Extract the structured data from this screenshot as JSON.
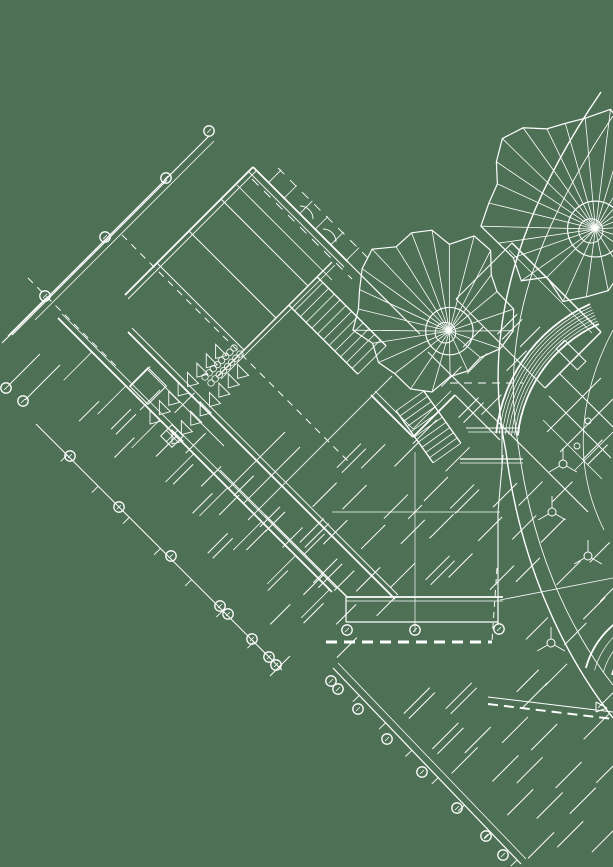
{
  "canvas": {
    "width": 613,
    "height": 867
  },
  "colors": {
    "background": "#4e7055",
    "ink": "#ffffff"
  },
  "drawing": {
    "lines": [
      {
        "x1": 209,
        "y1": 136,
        "x2": 30,
        "y2": 315,
        "w": 1.2
      },
      {
        "x1": 214,
        "y1": 141,
        "x2": 35,
        "y2": 320,
        "w": 0.8
      },
      {
        "x1": 167,
        "y1": 180,
        "x2": 12,
        "y2": 335,
        "w": 1.2
      },
      {
        "x1": 106,
        "y1": 239,
        "x2": 2,
        "y2": 343,
        "w": 1.2
      },
      {
        "x1": 46,
        "y1": 298,
        "x2": 8,
        "y2": 336,
        "w": 1.2
      },
      {
        "x1": 8,
        "y1": 386,
        "x2": 40,
        "y2": 354,
        "w": 1
      },
      {
        "x1": 25,
        "y1": 400,
        "x2": 60,
        "y2": 365,
        "w": 1
      },
      {
        "x1": 122,
        "y1": 235,
        "x2": 348,
        "y2": 461,
        "w": 1,
        "dash": [
          7,
          6
        ]
      },
      {
        "x1": 28,
        "y1": 278,
        "x2": 118,
        "y2": 368,
        "w": 1,
        "dash": [
          7,
          6
        ]
      },
      {
        "x1": 252,
        "y1": 179,
        "x2": 352,
        "y2": 279,
        "w": 1,
        "dash": [
          9,
          8
        ]
      },
      {
        "x1": 278,
        "y1": 168,
        "x2": 368,
        "y2": 258,
        "w": 0.9,
        "dash": [
          9,
          8
        ]
      },
      {
        "x1": 58,
        "y1": 318,
        "x2": 332,
        "y2": 592,
        "w": 1.8
      },
      {
        "x1": 62,
        "y1": 314,
        "x2": 336,
        "y2": 588,
        "w": 0.8
      },
      {
        "x1": 36,
        "y1": 424,
        "x2": 282,
        "y2": 670,
        "w": 1
      },
      {
        "x1": 128,
        "y1": 332,
        "x2": 395,
        "y2": 599,
        "w": 1.8
      },
      {
        "x1": 132,
        "y1": 328,
        "x2": 398,
        "y2": 595,
        "w": 0.9
      },
      {
        "x1": 253,
        "y1": 167,
        "x2": 125,
        "y2": 295,
        "w": 1.8
      },
      {
        "x1": 256,
        "y1": 171,
        "x2": 128,
        "y2": 299,
        "w": 0.9
      },
      {
        "x1": 253,
        "y1": 167,
        "x2": 348,
        "y2": 262,
        "w": 1.8
      },
      {
        "x1": 249,
        "y1": 172,
        "x2": 344,
        "y2": 267,
        "w": 0.9
      },
      {
        "x1": 237,
        "y1": 185,
        "x2": 332,
        "y2": 280,
        "w": 0.8
      },
      {
        "x1": 348,
        "y1": 262,
        "x2": 420,
        "y2": 334,
        "w": 1.2
      },
      {
        "x1": 218,
        "y1": 376,
        "x2": 332,
        "y2": 262,
        "w": 1.5
      },
      {
        "x1": 221,
        "y1": 379,
        "x2": 335,
        "y2": 265,
        "w": 0.8
      },
      {
        "x1": 157,
        "y1": 263,
        "x2": 244,
        "y2": 350,
        "w": 1
      },
      {
        "x1": 189,
        "y1": 231,
        "x2": 276,
        "y2": 318,
        "w": 1
      },
      {
        "x1": 221,
        "y1": 199,
        "x2": 308,
        "y2": 286,
        "w": 1
      },
      {
        "x1": 148,
        "y1": 370,
        "x2": 224,
        "y2": 446,
        "w": 0.9
      },
      {
        "x1": 166,
        "y1": 430,
        "x2": 178,
        "y2": 442,
        "w": 0.8
      },
      {
        "x1": 166,
        "y1": 442,
        "x2": 178,
        "y2": 430,
        "w": 0.8
      },
      {
        "x1": 371,
        "y1": 395,
        "x2": 413,
        "y2": 437,
        "w": 1.8
      },
      {
        "x1": 413,
        "y1": 437,
        "x2": 455,
        "y2": 395,
        "w": 1.8
      },
      {
        "x1": 375,
        "y1": 391,
        "x2": 413,
        "y2": 429,
        "w": 0.8
      },
      {
        "x1": 413,
        "y1": 429,
        "x2": 451,
        "y2": 391,
        "w": 0.8
      },
      {
        "x1": 455,
        "y1": 395,
        "x2": 500,
        "y2": 440,
        "w": 1.2
      },
      {
        "x1": 450,
        "y1": 383,
        "x2": 523,
        "y2": 383,
        "w": 1,
        "dash": [
          8,
          6
        ]
      },
      {
        "x1": 497,
        "y1": 568,
        "x2": 492,
        "y2": 641,
        "w": 1,
        "dash": [
          6,
          5
        ]
      },
      {
        "x1": 326,
        "y1": 642,
        "x2": 492,
        "y2": 642,
        "w": 3,
        "dash": [
          11,
          7
        ]
      },
      {
        "x1": 488,
        "y1": 697,
        "x2": 613,
        "y2": 712,
        "w": 1
      },
      {
        "x1": 488,
        "y1": 704,
        "x2": 613,
        "y2": 719,
        "w": 2,
        "dash": [
          10,
          6
        ]
      },
      {
        "x1": 265,
        "y1": 515,
        "x2": 347,
        "y2": 597,
        "w": 1.5
      },
      {
        "x1": 265,
        "y1": 515,
        "x2": 220,
        "y2": 470,
        "w": 1
      },
      {
        "x1": 228,
        "y1": 489,
        "x2": 285,
        "y2": 432,
        "w": 0.9
      },
      {
        "x1": 243,
        "y1": 504,
        "x2": 300,
        "y2": 447,
        "w": 0.9
      },
      {
        "x1": 248,
        "y1": 520,
        "x2": 392,
        "y2": 376,
        "w": 0.9
      },
      {
        "x1": 428,
        "y1": 352,
        "x2": 588,
        "y2": 512,
        "w": 1.1
      },
      {
        "x1": 346,
        "y1": 597,
        "x2": 503,
        "y2": 597,
        "w": 1.8
      },
      {
        "x1": 346,
        "y1": 601,
        "x2": 503,
        "y2": 601,
        "w": 0.8
      },
      {
        "x1": 346,
        "y1": 622,
        "x2": 498,
        "y2": 622,
        "w": 1.2
      },
      {
        "x1": 346,
        "y1": 597,
        "x2": 346,
        "y2": 622,
        "w": 1.2
      },
      {
        "x1": 498,
        "y1": 597,
        "x2": 498,
        "y2": 624,
        "w": 1.2
      },
      {
        "x1": 415,
        "y1": 452,
        "x2": 415,
        "y2": 632,
        "w": 0.7
      },
      {
        "x1": 332,
        "y1": 512,
        "x2": 500,
        "y2": 512,
        "w": 0.7
      },
      {
        "x1": 408,
        "y1": 519,
        "x2": 422,
        "y2": 505,
        "w": 0.9
      },
      {
        "x1": 502,
        "y1": 424,
        "x2": 502,
        "y2": 470,
        "w": 1
      },
      {
        "x1": 466,
        "y1": 428,
        "x2": 520,
        "y2": 428,
        "w": 1
      },
      {
        "x1": 468,
        "y1": 432,
        "x2": 520,
        "y2": 432,
        "w": 0.7
      },
      {
        "x1": 460,
        "y1": 459,
        "x2": 523,
        "y2": 459,
        "w": 1.2
      },
      {
        "x1": 460,
        "y1": 463,
        "x2": 523,
        "y2": 463,
        "w": 0.7
      },
      {
        "x1": 512,
        "y1": 243,
        "x2": 601,
        "y2": 332,
        "w": 1.5
      },
      {
        "x1": 601,
        "y1": 332,
        "x2": 545,
        "y2": 388,
        "w": 1.5
      },
      {
        "x1": 545,
        "y1": 388,
        "x2": 456,
        "y2": 299,
        "w": 1
      },
      {
        "x1": 456,
        "y1": 299,
        "x2": 512,
        "y2": 243,
        "w": 1
      },
      {
        "x1": 509,
        "y1": 250,
        "x2": 592,
        "y2": 333,
        "w": 0.7
      },
      {
        "x1": 560,
        "y1": 374,
        "x2": 613,
        "y2": 427,
        "w": 1
      },
      {
        "x1": 549,
        "y1": 396,
        "x2": 611,
        "y2": 458,
        "w": 1
      },
      {
        "x1": 543,
        "y1": 420,
        "x2": 602,
        "y2": 479,
        "w": 0.8
      },
      {
        "x1": 547,
        "y1": 432,
        "x2": 601,
        "y2": 378,
        "w": 1
      },
      {
        "x1": 560,
        "y1": 452,
        "x2": 613,
        "y2": 399,
        "w": 1
      },
      {
        "x1": 575,
        "y1": 470,
        "x2": 613,
        "y2": 432,
        "w": 0.8
      },
      {
        "x1": 503,
        "y1": 455,
        "x2": 498,
        "y2": 512,
        "w": 1
      },
      {
        "x1": 498,
        "y1": 512,
        "x2": 498,
        "y2": 624,
        "w": 1.1
      },
      {
        "x1": 613,
        "y1": 578,
        "x2": 500,
        "y2": 600,
        "w": 0.8
      },
      {
        "x1": 333,
        "y1": 668,
        "x2": 521,
        "y2": 864,
        "w": 1.2
      },
      {
        "x1": 338,
        "y1": 663,
        "x2": 526,
        "y2": 859,
        "w": 0.8
      },
      {
        "x1": 270,
        "y1": 676,
        "x2": 290,
        "y2": 656,
        "w": 1
      },
      {
        "x1": 596,
        "y1": 702,
        "x2": 607,
        "y2": 708,
        "w": 1
      },
      {
        "x1": 607,
        "y1": 708,
        "x2": 596,
        "y2": 712,
        "w": 1
      },
      {
        "x1": 596,
        "y1": 712,
        "x2": 596,
        "y2": 702,
        "w": 1
      }
    ],
    "combs": [
      {
        "x1": 58,
        "y1": 318,
        "x2": 332,
        "y2": 592,
        "step": 48,
        "len": 40,
        "side": 1,
        "w": 0.8
      },
      {
        "x1": 253,
        "y1": 167,
        "x2": 348,
        "y2": 262,
        "step": 22,
        "len": 18,
        "side": -1,
        "w": 0.8
      },
      {
        "x1": 36,
        "y1": 424,
        "x2": 282,
        "y2": 670,
        "step": 44,
        "len": 9,
        "side": 1,
        "w": 0.9
      },
      {
        "x1": 333,
        "y1": 668,
        "x2": 521,
        "y2": 864,
        "step": 38,
        "len": 9,
        "side": 1,
        "w": 0.9
      }
    ],
    "stairs": [
      {
        "x1": 303,
        "y1": 291,
        "x2": 372,
        "y2": 360,
        "hw": 20,
        "steps": 12
      },
      {
        "x1": 410,
        "y1": 401,
        "x2": 447,
        "y2": 453,
        "hw": 17,
        "steps": 10
      }
    ],
    "rects": [
      {
        "cx": 148,
        "cy": 386,
        "w": 26,
        "h": 26,
        "rot": 45
      },
      {
        "cx": 172,
        "cy": 436,
        "w": 16,
        "h": 16,
        "rot": 45
      },
      {
        "cx": 571,
        "cy": 355,
        "w": 30,
        "h": 12,
        "rot": 45
      }
    ],
    "doorArcs": [
      {
        "cx": 300,
        "cy": 219,
        "r": 13,
        "a1": -90,
        "a2": 0
      },
      {
        "cx": 323,
        "cy": 242,
        "r": 13,
        "a1": -90,
        "a2": 0
      }
    ],
    "arcBands": [
      {
        "cx": 655,
        "cy": 450,
        "r0": 138,
        "dr": 3.1,
        "count": 8,
        "a1": 186,
        "a2": 246
      },
      {
        "cx": 668,
        "cy": 690,
        "r0": 58,
        "dr": 9,
        "count": 4,
        "a1": 195,
        "a2": 262
      }
    ],
    "beziers": [
      {
        "d": "M 601,92 C 520,210 480,330 506,452",
        "w": 1.4
      },
      {
        "d": "M 613,116 C 540,225 497,330 519,450",
        "w": 0.9
      },
      {
        "d": "M 506,452 C 520,560 560,650 613,718",
        "w": 1.4
      },
      {
        "d": "M 519,450 C 532,545 566,625 613,685",
        "w": 0.9
      },
      {
        "d": "M 613,330 C 576,400 574,470 604,530",
        "w": 0.8
      }
    ],
    "trees": [
      {
        "cx": 575,
        "cy": 203,
        "r": 93,
        "n": 26,
        "seed": 7
      },
      {
        "cx": 432,
        "cy": 309,
        "r": 79,
        "n": 24,
        "seed": 13
      }
    ],
    "bubbles": [
      [
        209,
        131
      ],
      [
        166,
        178
      ],
      [
        105,
        237
      ],
      [
        45,
        296
      ],
      [
        6,
        388
      ],
      [
        23,
        401
      ],
      [
        70,
        456
      ],
      [
        119,
        507
      ],
      [
        171,
        556
      ],
      [
        220,
        606
      ],
      [
        228,
        614
      ],
      [
        252,
        639
      ],
      [
        269,
        657
      ],
      [
        276,
        665
      ],
      [
        331,
        681
      ],
      [
        338,
        689
      ],
      [
        358,
        709
      ],
      [
        387,
        739
      ],
      [
        422,
        772
      ],
      [
        457,
        808
      ],
      [
        486,
        836
      ],
      [
        503,
        855
      ],
      [
        347,
        630
      ],
      [
        415,
        630
      ],
      [
        499,
        629
      ]
    ],
    "smallCircles": [
      [
        588,
        421
      ],
      [
        577,
        446
      ]
    ],
    "targets": [
      [
        563,
        464
      ],
      [
        552,
        512
      ],
      [
        551,
        643
      ],
      [
        588,
        556
      ]
    ],
    "pennantRows": [
      {
        "x1": 150,
        "y1": 410,
        "x2": 225,
        "y2": 335,
        "count": 8
      },
      {
        "x1": 172,
        "y1": 430,
        "x2": 247,
        "y2": 355,
        "count": 8
      }
    ],
    "circleRows": [
      {
        "x1": 205,
        "y1": 377,
        "x2": 234,
        "y2": 348,
        "count": 8,
        "r": 3.2,
        "offsets": [
          [
            0,
            0
          ],
          [
            6,
            6
          ]
        ]
      }
    ],
    "hatch": [
      {
        "poly": [
          [
            66,
            408
          ],
          [
            130,
            342
          ],
          [
            396,
            600
          ],
          [
            332,
            666
          ]
        ],
        "spacing": 34,
        "len": 20,
        "seed": 3
      },
      {
        "poly": [
          [
            268,
            516
          ],
          [
            310,
            470
          ],
          [
            352,
            445
          ],
          [
            430,
            425
          ],
          [
            588,
            518
          ],
          [
            588,
            594
          ],
          [
            348,
            594
          ]
        ],
        "spacing": 36,
        "len": 24,
        "seed": 5
      },
      {
        "poly": [
          [
            432,
            356
          ],
          [
            500,
            300
          ],
          [
            548,
            344
          ],
          [
            470,
            428
          ]
        ],
        "spacing": 34,
        "len": 20,
        "seed": 9
      },
      {
        "poly": [
          [
            402,
            694
          ],
          [
            613,
            694
          ],
          [
            613,
            866
          ],
          [
            520,
            866
          ]
        ],
        "spacing": 37,
        "len": 26,
        "seed": 11
      },
      {
        "poly": [
          [
            545,
            470
          ],
          [
            610,
            415
          ],
          [
            613,
            595
          ],
          [
            558,
            585
          ]
        ],
        "spacing": 44,
        "len": 20,
        "seed": 17
      },
      {
        "poly": [
          [
            505,
            600
          ],
          [
            613,
            600
          ],
          [
            613,
            690
          ],
          [
            505,
            690
          ]
        ],
        "spacing": 40,
        "len": 22,
        "seed": 21
      }
    ]
  }
}
